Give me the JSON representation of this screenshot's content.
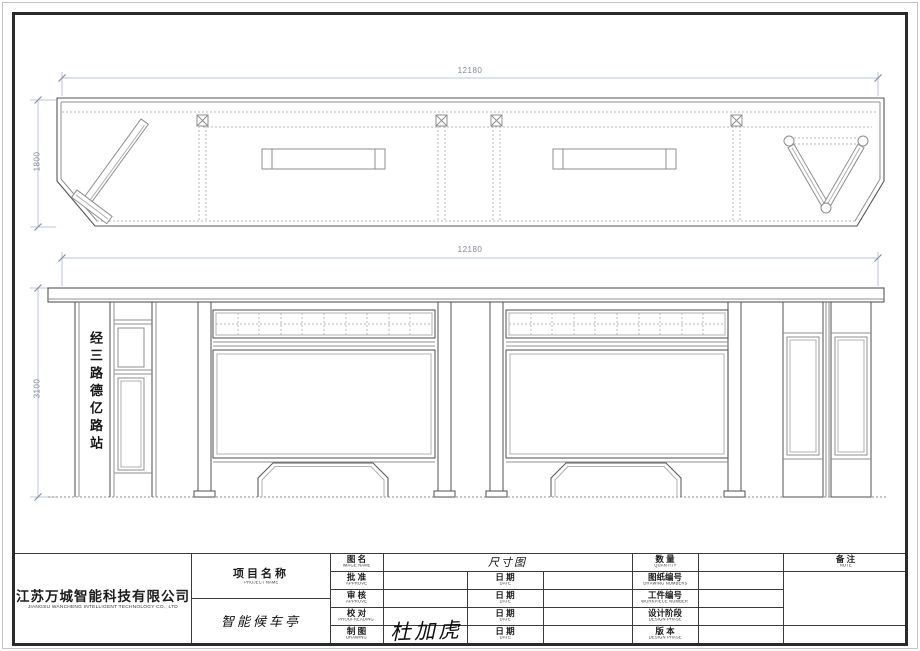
{
  "views": {
    "plan": {
      "width_dim": "12180",
      "depth_dim": "1800"
    },
    "elevation": {
      "width_dim": "12180",
      "height_dim": "3100",
      "station_sign": "经三路德亿路站"
    }
  },
  "title_block": {
    "company": {
      "name_cn": "江苏万城智能科技有限公司",
      "name_en": "JIANGSU WANCHENG INTELLIGENT TECHNOLOGY CO., LTD"
    },
    "project": {
      "label_cn": "项目名称",
      "label_en": "PROJECT NAME",
      "value": "智能候车亭"
    },
    "drawing_name": {
      "label_cn": "图 名",
      "label_en": "IMAGE NAME",
      "value": "尺寸图"
    },
    "sign_rows": [
      {
        "label_cn": "批 准",
        "label_en": "APPROVE",
        "value": "",
        "date_cn": "日 期",
        "date_en": "DATE",
        "date_value": ""
      },
      {
        "label_cn": "审 核",
        "label_en": "APPROVE",
        "value": "",
        "date_cn": "日 期",
        "date_en": "DATE",
        "date_value": ""
      },
      {
        "label_cn": "校 对",
        "label_en": "PROOFREADING",
        "value": "",
        "date_cn": "日 期",
        "date_en": "DATE",
        "date_value": ""
      },
      {
        "label_cn": "制 图",
        "label_en": "DRAWING",
        "value": "杜加虎",
        "date_cn": "日 期",
        "date_en": "DATE",
        "date_value": ""
      }
    ],
    "spec_rows": [
      {
        "label_cn": "数 量",
        "label_en": "QUANTITY",
        "value": ""
      },
      {
        "label_cn": "图纸编号",
        "label_en": "DRAWING NUMBERS",
        "value": ""
      },
      {
        "label_cn": "工件编号",
        "label_en": "WORKPIECE NUMBER",
        "value": ""
      },
      {
        "label_cn": "设计阶段",
        "label_en": "DESIGN PHASE",
        "value": ""
      },
      {
        "label_cn": "版 本",
        "label_en": "DESIGN PHASE",
        "value": ""
      }
    ],
    "note": {
      "label_cn": "备 注",
      "label_en": "NOTE",
      "value": ""
    }
  },
  "colors": {
    "frame": "#2a2a2a",
    "drawing_line": "#5e5e5e",
    "dimension_line": "#bcc3dd",
    "paper": "#ffffff"
  }
}
